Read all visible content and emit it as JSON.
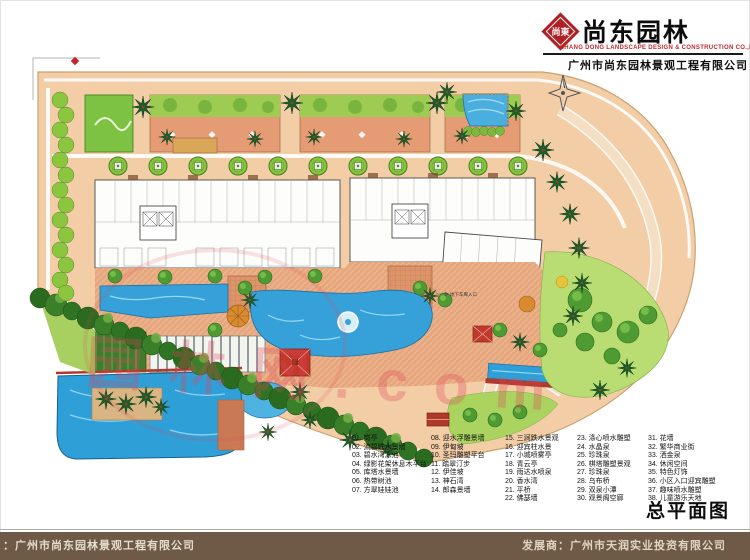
{
  "header": {
    "logo_text": "尚東",
    "title_cn": "尚东园林",
    "subtitle_en": "SHANG DONG LANDSCAPE DESIGN & CONSTRUCTION CO.,LTD",
    "company_cn": "广州市尚东园林景观工程有限公司"
  },
  "plan": {
    "garage_label": "地下车库入口"
  },
  "watermark": {
    "text": "园林网.com"
  },
  "legend": {
    "columns": [
      {
        "items": [
          "01. 岗亭",
          "02. 流碧跌水景墙",
          "03. 碧水湾泳池",
          "04. 绿影花架休息木平台",
          "05. 库塔水景墙",
          "06. 热带树池",
          "07. 方翠娃娃池"
        ]
      },
      {
        "items": [
          "08. 迎水浮雕景墙",
          "09. 伊甸坡",
          "10. 圣玛雕塑平台",
          "11. 踏翠汀步",
          "12. 伊佳坡",
          "13. 神石湾",
          "14. 郎森景墙"
        ]
      },
      {
        "items": [
          "15. 三涧跌水景观",
          "16. 迎宾柱水景",
          "17. 小城喷雾亭",
          "18. 青云亭",
          "19. 雨达水喷泉",
          "20. 香水湾",
          "21. 平桥",
          "22. 佛瑟墙"
        ]
      },
      {
        "items": [
          "23. 涤心喷水雕塑",
          "24. 水晶泉",
          "25. 珍珠泉",
          "26. 棋塔雕塑景观",
          "27. 珍珠泉",
          "28. 乌布桥",
          "29. 双泉小潭",
          "30. 观景阁空廊"
        ]
      },
      {
        "items": [
          "31. 花墙",
          "32. 繁华商业街",
          "33. 洒金泉",
          "34. 休闲空间",
          "35. 特色灯饰",
          "36. 小区入口迎宾雕塑",
          "37. 趣味喷水雕塑",
          "38. 儿童游乐天地"
        ]
      }
    ]
  },
  "title_block": {
    "plan_title": "总平面图"
  },
  "footer": {
    "left": "：广州市尚东园林景观工程有限公司",
    "right": "发展商：广州市天润实业投资有限公司"
  },
  "icons": {
    "logo": "red-diamond-seal",
    "north_arrow": "compass-star"
  },
  "colors": {
    "brand_red": "#b01f24",
    "footer_brown": "#6e5a47",
    "pool_blue": "#2f9fd8",
    "road_peach": "#f2cda6",
    "paving_terracotta": "#e7a77d",
    "lawn_green": "#b9dd72",
    "tree_green": "#2e6e23",
    "watermark_pink": "#de465a"
  }
}
